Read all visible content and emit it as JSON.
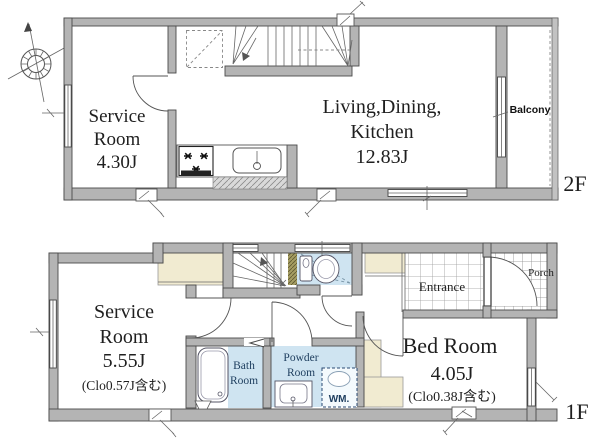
{
  "floor2": {
    "floor_label": "2F",
    "service_room": {
      "line1": "Service",
      "line2": "Room",
      "area": "4.30J"
    },
    "ldk": {
      "line1": "Living,Dining,",
      "line2": "Kitchen",
      "area": "12.83J"
    },
    "balcony_label": "Balcony"
  },
  "floor1": {
    "floor_label": "1F",
    "service_room": {
      "line1": "Service",
      "line2": "Room",
      "area": "5.55J",
      "note": "(Clo0.57J含む)"
    },
    "bed_room": {
      "name": "Bed Room",
      "area": "4.05J",
      "note": "(Clo0.38J含む)"
    },
    "bath_room": {
      "line1": "Bath",
      "line2": "Room"
    },
    "powder_room": {
      "line1": "Powder",
      "line2": "Room"
    },
    "washing_machine_label": "WM.",
    "entrance_label": "Entrance",
    "porch_label": "Porch"
  },
  "colors": {
    "wall_fill": "#b4b4b4",
    "wall_outline": "#4a4a4a",
    "water_room_fill": "#cfe4f1",
    "closet_fill": "#f1ebd1",
    "shelf_fill": "#a59d62",
    "room_label": "#1f1f1f",
    "water_label": "#1d3d5e",
    "background": "#ffffff"
  }
}
